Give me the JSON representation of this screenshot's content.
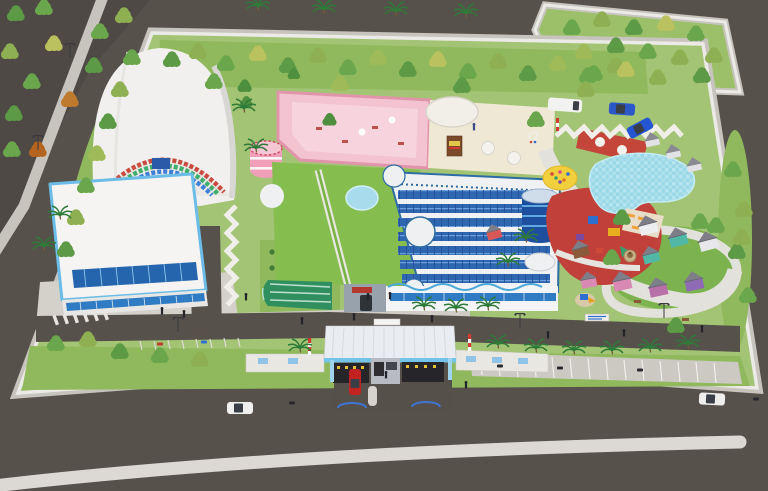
{
  "image": {
    "kind": "3d-aerial-architectural-render",
    "alt": "Bird's-eye 3D rendering of a walled recreation campus: barrel-vault sports hall, main building with roof garden and solar panels, rooftop terraces, swimming pool, red playground, mini town of small houses, entrance gate house, perimeter roads with cars and trees",
    "legible_text": "none"
  },
  "palette": {
    "road": "#57514b",
    "road_dark": "#4e4944",
    "sidewalk": "#c7c4be",
    "wall": "#eceae6",
    "lane_stripe": "#dcd9d4",
    "grass": "#a2c474",
    "grass_dark": "#8fb95c",
    "village_grass": "#7cb34e",
    "vault_white": "#f1f0ee",
    "hall_trim_blue": "#6cbce8",
    "glass_blue": "#2f7bc4",
    "skylight_blue": "#2465ae",
    "mosaic_red": "#c94a3e",
    "mosaic_green": "#3fae6c",
    "mosaic_blue": "#3f7fd8",
    "pink_terrace": "#f3c3d1",
    "pink_wall": "#e095ab",
    "pink_tower": "#efa0b8",
    "cream_terrace": "#efe8d5",
    "green_roof": "#86bd4f",
    "roof_white": "#f0f1f3",
    "solar_blue": "#2f66b0",
    "solar_border": "#2e6da4",
    "pond_blue": "#a8dcec",
    "pool_blue": "#9ad7e7",
    "play_red": "#c2403a",
    "deck_red": "#c4453a",
    "lounger_orange": "#f0a23c",
    "sand_yellow": "#f2cf3d",
    "tank_blue": "#1d4f9e",
    "tank_stripe": "#5fa8e0",
    "canopy_white": "#e9ecf0",
    "fascia_blue": "#74c4ea",
    "gate_light_yellow": "#e6c23a",
    "plaque_blue": "#8fc3e8",
    "striped_pole_red": "#d03a30",
    "car_red": "#c22320",
    "car_blue": "#2b57c8",
    "van_white": "#f2f2f0",
    "palm_green": "#2e7a38",
    "tree_green_dark": "#4e8f3e",
    "tree_green": "#5c9a46",
    "tree_green_mid": "#6aa64b",
    "tree_green_light": "#8fb052",
    "tree_yellow_green": "#b9c25e",
    "tree_orange": "#c07a2e",
    "house_roof_gray": "#7e7e88",
    "house_teal": "#52b8a6",
    "house_pink": "#d889b4",
    "house_purple": "#8f6bb5",
    "house_brown": "#8a5a3a",
    "fountain_tan": "#c8b088"
  },
  "counts": {
    "solar_panel_rows": 7,
    "village_houses": 10,
    "pool_cabins": 3,
    "entrance_lanes": 2,
    "cars": 5,
    "vans": 1,
    "motorbikes": 2,
    "striped_poles": 3
  }
}
